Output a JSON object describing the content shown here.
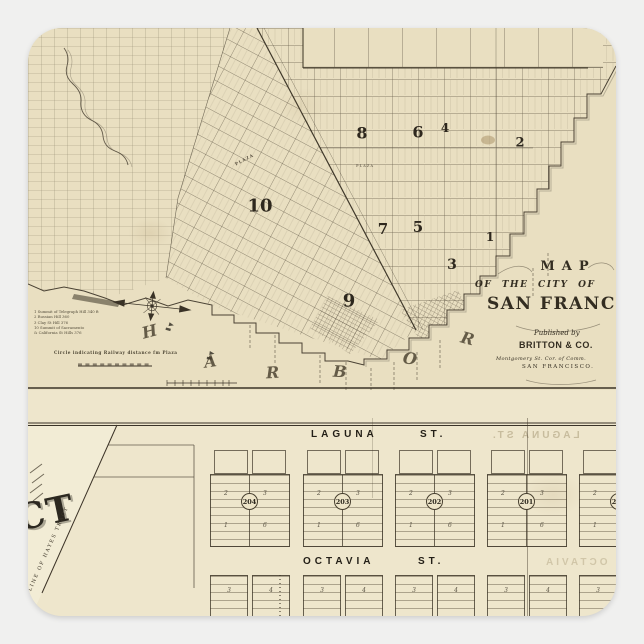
{
  "page": {
    "background_color": "#f0f0ef"
  },
  "sticker": {
    "shape": "rounded-square",
    "paper_color": "#e9dfc1",
    "ink_color": "#3a3327"
  },
  "upper_map": {
    "district_numbers": [
      "8",
      "6",
      "4",
      "2",
      "10",
      "7",
      "5",
      "3",
      "1",
      "9"
    ],
    "plaza_label": "PLAZA",
    "harbor_letters": [
      "H",
      "A",
      "R",
      "B",
      "O",
      "R"
    ],
    "cartouche": {
      "map_word": "MAP",
      "of_the_city": "OF THE CITY OF",
      "city_name": "SAN FRANCISCO",
      "published_by": "Published by",
      "publisher": "BRITTON & CO.",
      "address": "Montgomery St.  Cor. of Comm.",
      "address_city": "SAN FRANCISCO."
    },
    "legend_lines": [
      "1  Summit of Telegraph Hill   340 ft",
      "2  Russian Hill   360",
      "3  Clay St Hill   376",
      "10  Summit of Sacramento",
      "&  California St Hills   376"
    ],
    "legend_note": "Circle indicating Railway distance fm Plaza"
  },
  "lower_map": {
    "streets": [
      {
        "name": "LAGUNA",
        "type": "ST."
      },
      {
        "name": "OCTAVIA",
        "type": "ST."
      }
    ],
    "ghost_streets": [
      {
        "name": "LAGUNA",
        "type": "ST."
      },
      {
        "name": "OCTAVIA",
        "type": "ST."
      }
    ],
    "blocks": [
      {
        "number": "204",
        "lots": [
          "2",
          "3",
          "1",
          "6"
        ]
      },
      {
        "number": "203",
        "lots": [
          "2",
          "3",
          "1",
          "6"
        ]
      },
      {
        "number": "202",
        "lots": [
          "2",
          "3",
          "1",
          "6"
        ]
      },
      {
        "number": "201",
        "lots": [
          "2",
          "3",
          "1",
          "6"
        ]
      },
      {
        "number": "200",
        "lots": [
          "2",
          "3",
          "1",
          "6"
        ]
      }
    ],
    "row_b_lot_labels": [
      "3",
      "4"
    ],
    "tract_boundary_label": "LINE OF HAYES TRACT",
    "large_partial_label": "CT"
  }
}
